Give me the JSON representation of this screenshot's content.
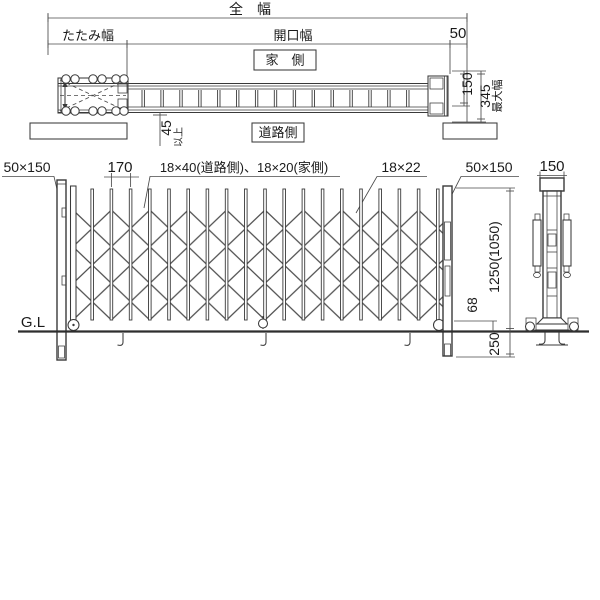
{
  "drawing": {
    "line_color": "#3a3a3a",
    "text_color": "#1a1a1a",
    "background": "#ffffff"
  },
  "top_view": {
    "dim_total_width": "全　幅",
    "dim_fold_width": "たたみ幅",
    "dim_opening_width": "開口幅",
    "dim_post_offset": "50",
    "house_side_label": "家　側",
    "road_side_label": "道路側",
    "clearance_value": "45",
    "clearance_suffix": "以上",
    "dim_rail_width": "150",
    "dim_max_width": "345",
    "max_width_label": "最大幅"
  },
  "elevation": {
    "post_left_size": "50×150",
    "dim_pitch": "170",
    "bar_size_label": "18×40(道路側)、18×20(家側)",
    "brace_size_label": "18×22",
    "post_right_size": "50×150",
    "ground_label": "G.L",
    "dim_height": "1250(1050)",
    "dim_caster": "68",
    "dim_embed": "250"
  },
  "side_view": {
    "dim_post_width": "150"
  },
  "structure": {
    "bar_start_x": 73,
    "bar_pitch": 19.2,
    "bar_count": 19,
    "bar_top": 189,
    "bar_bottom": 320,
    "plan_tick_start": 142,
    "plan_tick_pitch": 18.9,
    "plan_tick_count": 15,
    "plan_tick_top": 90,
    "plan_tick_bottom": 107,
    "fold_caster_x": [
      66,
      75,
      93,
      102,
      116,
      124
    ],
    "fold_caster_rows": [
      79,
      111
    ]
  }
}
